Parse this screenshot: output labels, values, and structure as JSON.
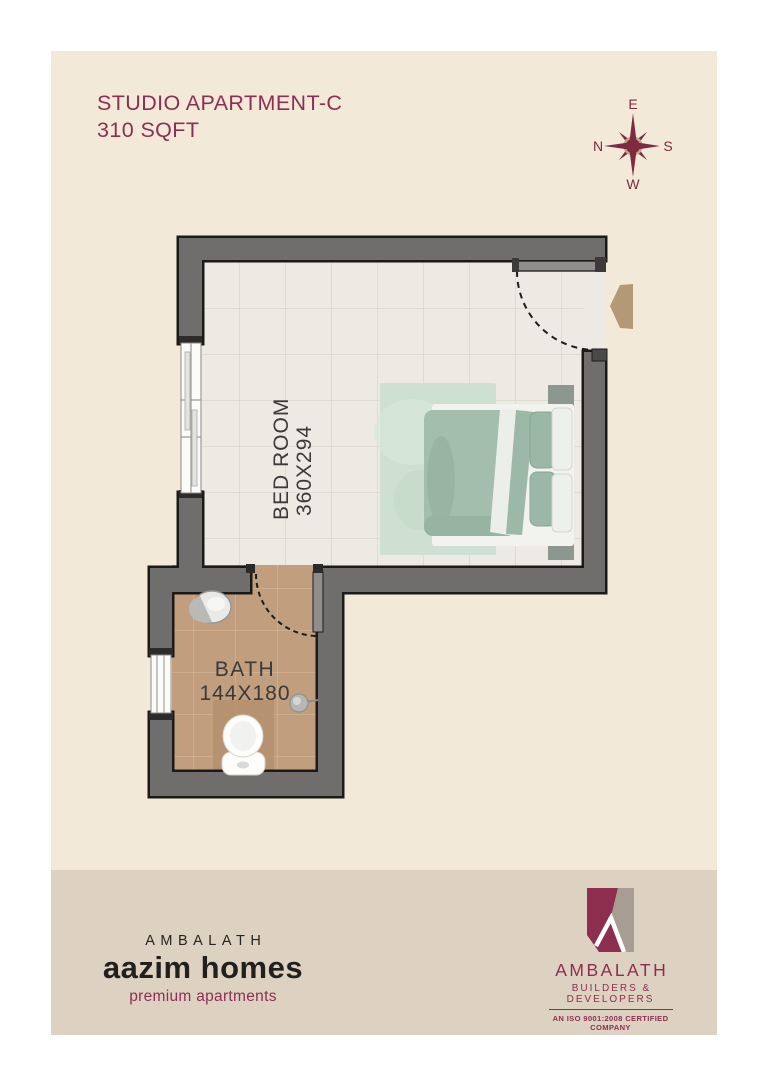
{
  "title": {
    "line1": "STUDIO APARTMENT-C",
    "line2": "310 SQFT"
  },
  "compass": {
    "top": "E",
    "right": "S",
    "bottom": "W",
    "left": "N"
  },
  "plan": {
    "rooms": [
      {
        "name": "BED ROOM",
        "dimensions": "360X294"
      },
      {
        "name": "BATH",
        "dimensions": "144X180"
      }
    ]
  },
  "footer": {
    "brand": {
      "name": "AMBALATH",
      "product": "aazim homes",
      "tagline": "premium apartments"
    },
    "company": {
      "name": "AMBALATH",
      "division": "BUILDERS & DEVELOPERS",
      "certification": "AN ISO 9001:2008 CERTIFIED COMPANY"
    }
  },
  "colors": {
    "maroon": "#8d2f52",
    "cream_background": "#f2e9d9",
    "footer_strip": "#ddd2c2",
    "wall_gray": "#6f6e6d",
    "bedroom_floor": "#edeae3",
    "bath_floor": "#c19e7d",
    "bed_sage": "#a3bead",
    "entry_arrow_tan": "#b49977"
  }
}
